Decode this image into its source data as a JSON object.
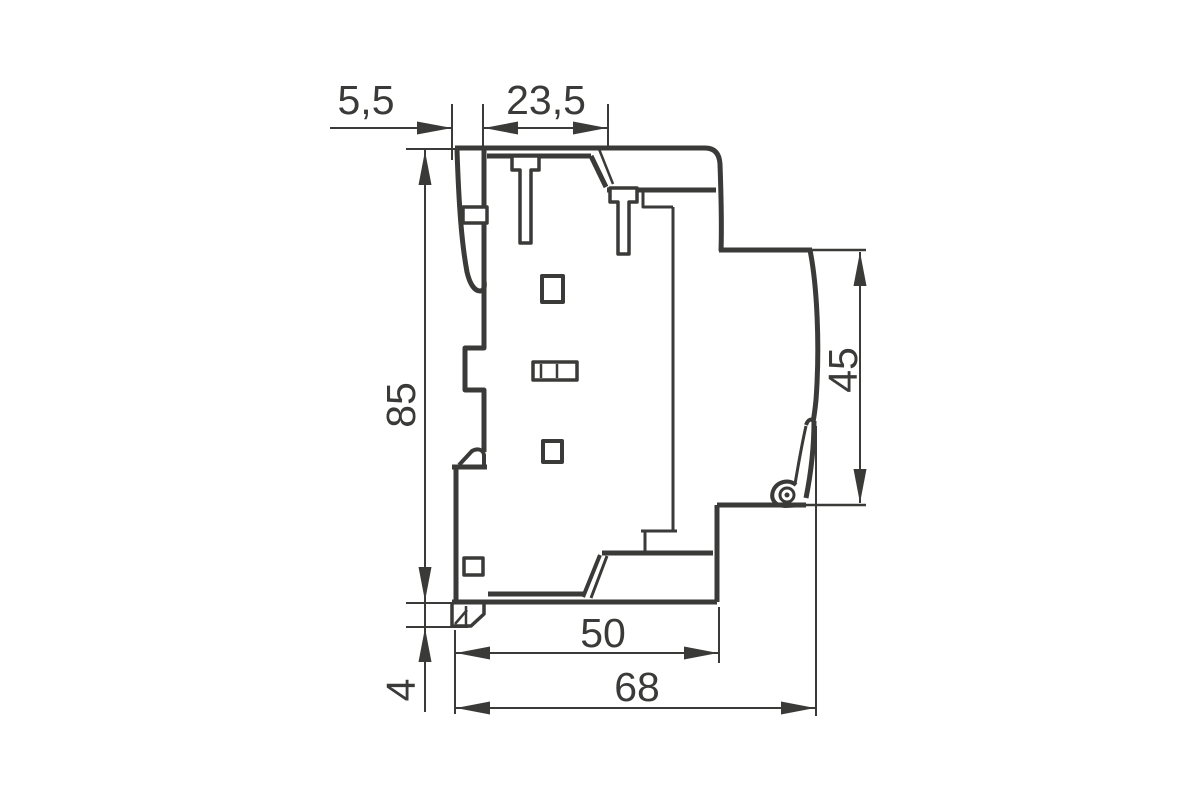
{
  "drawing": {
    "background_color": "#ffffff",
    "line_color": "#3a3a38",
    "labels": {
      "top_left_offset": "5,5",
      "top_terminal_width": "23,5",
      "overall_height": "85",
      "clip_foot_height": "4",
      "back_section_height": "45",
      "base_depth": "50",
      "overall_depth": "68"
    }
  }
}
